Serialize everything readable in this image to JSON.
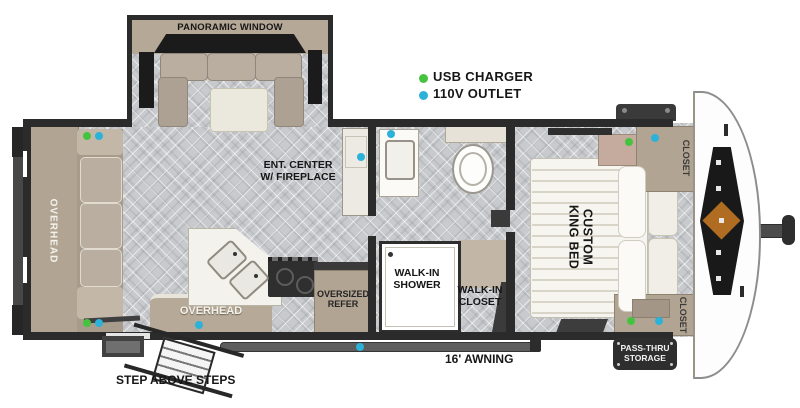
{
  "legend": {
    "usb_charger": {
      "label": "USB CHARGER",
      "dot_color": "#45c33e"
    },
    "outlet_110v": {
      "label": "110V OUTLET",
      "dot_color": "#2cb2d9"
    }
  },
  "labels": {
    "panoramic_window": "PANORAMIC WINDOW",
    "ent_center": [
      "ENT. CENTER",
      "W/ FIREPLACE"
    ],
    "overhead_rear": "OVERHEAD",
    "overhead_kitchen": "OVERHEAD",
    "oversized_refer": [
      "OVERSIZED",
      "REFER"
    ],
    "walk_in_shower": [
      "WALK-IN",
      "SHOWER"
    ],
    "walk_in_closet": [
      "WALK-IN",
      "CLOSET"
    ],
    "custom_king_bed": [
      "CUSTOM",
      "KING BED"
    ],
    "closet_front_top": "CLOSET",
    "closet_front_bottom": "CLOSET",
    "awning": "16' AWNING",
    "steps": "STEP ABOVE STEPS",
    "pass_thru_storage": [
      "PASS-THRU",
      "STORAGE"
    ]
  },
  "colors": {
    "wall": "#2b2b2b",
    "floor": "#c8cacd",
    "cabinet_tan": "#b2a492",
    "usb_green": "#45c33e",
    "outlet_cyan": "#2cb2d9",
    "logo_orange": "#b06c20"
  }
}
